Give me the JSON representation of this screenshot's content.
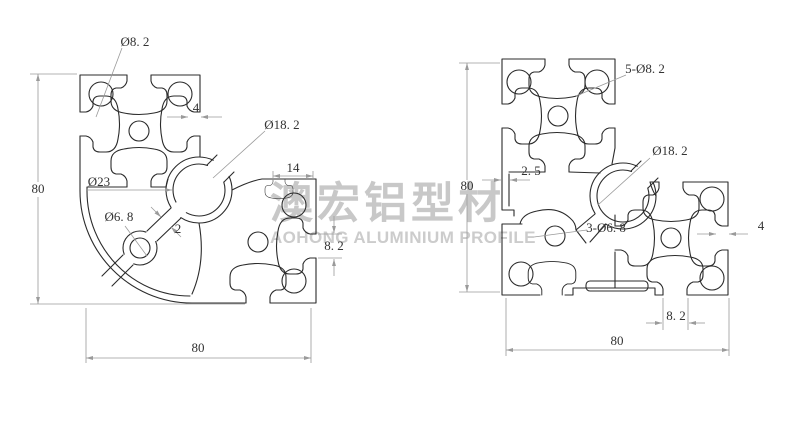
{
  "watermark": {
    "cn": "澳宏铝型材",
    "en": "AOHONG ALUMINIUM PROFILE",
    "color": "#c8c8c8"
  },
  "left_view": {
    "labels": {
      "corner_hole": "Ø8. 2",
      "slot_lip": "4",
      "bore": "Ø18. 2",
      "web_dia": "Ø23",
      "small_hole": "Ø6. 8",
      "wall": "2",
      "end_face": "14",
      "slot_open": "8. 2",
      "height": "80",
      "width": "80"
    }
  },
  "right_view": {
    "labels": {
      "corner_holes": "5-Ø8. 2",
      "wall": "2. 5",
      "bore": "Ø18. 2",
      "small_holes": "3-Ø6. 8",
      "slot_lip": "4",
      "slot_open": "8. 2",
      "height": "80",
      "width": "80"
    }
  },
  "colors": {
    "line": "#2b2b2b",
    "dimension": "#9a9a9a",
    "text": "#333333"
  }
}
